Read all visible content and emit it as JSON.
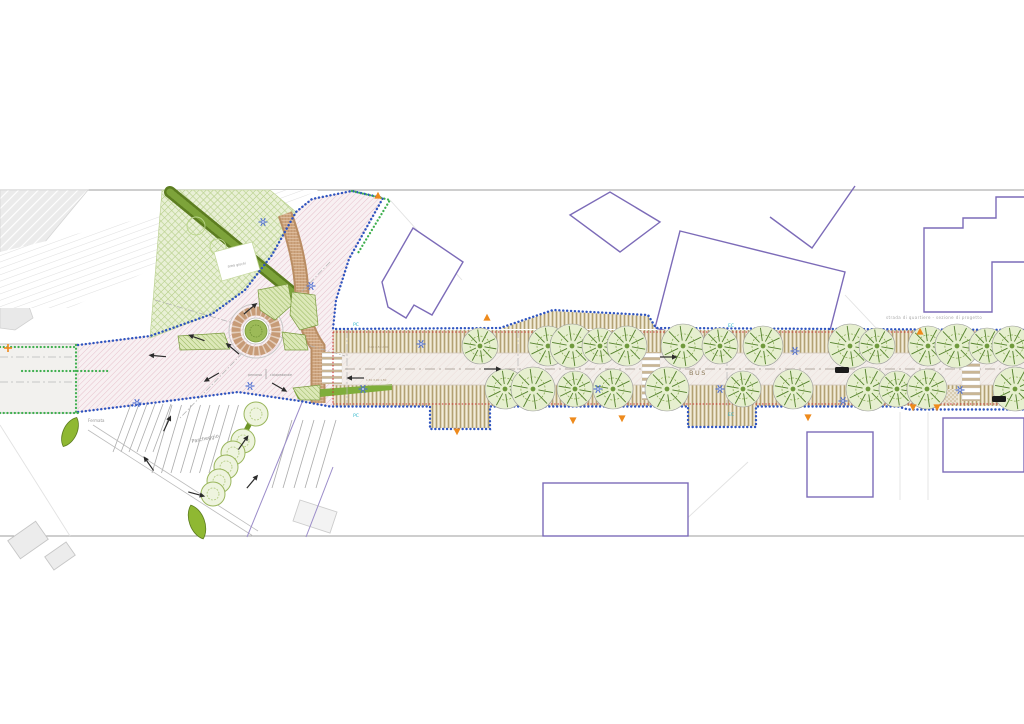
{
  "labels": {
    "parking": "Parcheggio",
    "bus": "BUS",
    "bus_stop": "Fermata",
    "play_area": "area giochi",
    "note_a": "percorso",
    "note_b": "ciclopedonale",
    "street_note": "strada di quartiere - sezione di progetto",
    "dims_north": "2.00   4.50   2.00",
    "dims_south": "1.50   3.00   1.50"
  },
  "codes": [
    {
      "t": "PC",
      "x": 356,
      "y": 326
    },
    {
      "t": "PC",
      "x": 356,
      "y": 417
    },
    {
      "t": "EC",
      "x": 731,
      "y": 327
    },
    {
      "t": "EC",
      "x": 731,
      "y": 416
    }
  ],
  "colors": {
    "boundary_blue": "#2f55c0",
    "boundary_green": "#3faf4f",
    "curb_red": "#cc3333",
    "building_purple": "#7c6bb8",
    "path_brown": "#c49a72",
    "tree_green": "#53802b",
    "marker_orange": "#ee8a1c",
    "utility_blue": "#4f6fd0",
    "code_cyan": "#2ab5c9"
  },
  "trees": {
    "north": {
      "y": 346,
      "xs": [
        480,
        548,
        572,
        600,
        627,
        683,
        720,
        763,
        850,
        877,
        928,
        957,
        987,
        1012
      ]
    },
    "south": {
      "y": 389,
      "xs": [
        505,
        533,
        575,
        613,
        667,
        743,
        793,
        868,
        897,
        927,
        1015
      ]
    },
    "parking": [
      [
        256,
        414
      ],
      [
        243,
        441
      ],
      [
        233,
        453
      ],
      [
        226,
        467
      ],
      [
        219,
        481
      ],
      [
        213,
        494
      ]
    ]
  },
  "symbols": {
    "utilities": [
      [
        263,
        222
      ],
      [
        311,
        286
      ],
      [
        250,
        386
      ],
      [
        137,
        403
      ],
      [
        363,
        389
      ],
      [
        421,
        344
      ],
      [
        598,
        389
      ],
      [
        720,
        389
      ],
      [
        795,
        351
      ],
      [
        843,
        401
      ],
      [
        960,
        390
      ]
    ],
    "orange_markers": [
      [
        378,
        196,
        0
      ],
      [
        487,
        318,
        0
      ],
      [
        920,
        332,
        0
      ],
      [
        457,
        431,
        180
      ],
      [
        573,
        420,
        180
      ],
      [
        622,
        418,
        180
      ],
      [
        808,
        417,
        180
      ],
      [
        913,
        407,
        180
      ],
      [
        937,
        407,
        180
      ]
    ],
    "arrows": [
      [
        492,
        369,
        0
      ],
      [
        668,
        357,
        0
      ],
      [
        356,
        378,
        180
      ],
      [
        250,
        309,
        -40
      ],
      [
        197,
        338,
        200
      ],
      [
        233,
        349,
        220
      ],
      [
        212,
        377,
        150
      ],
      [
        279,
        387,
        30
      ],
      [
        158,
        356,
        185
      ],
      [
        167,
        424,
        -65
      ],
      [
        149,
        464,
        235
      ],
      [
        196,
        494,
        15
      ],
      [
        243,
        443,
        -55
      ],
      [
        252,
        482,
        -50
      ]
    ],
    "cars": [
      [
        842,
        370
      ],
      [
        999,
        399
      ]
    ]
  },
  "crossings": [
    [
      322,
      352,
      20,
      32,
      5
    ],
    [
      642,
      352,
      18,
      48,
      7
    ],
    [
      962,
      351,
      18,
      50,
      7
    ]
  ]
}
